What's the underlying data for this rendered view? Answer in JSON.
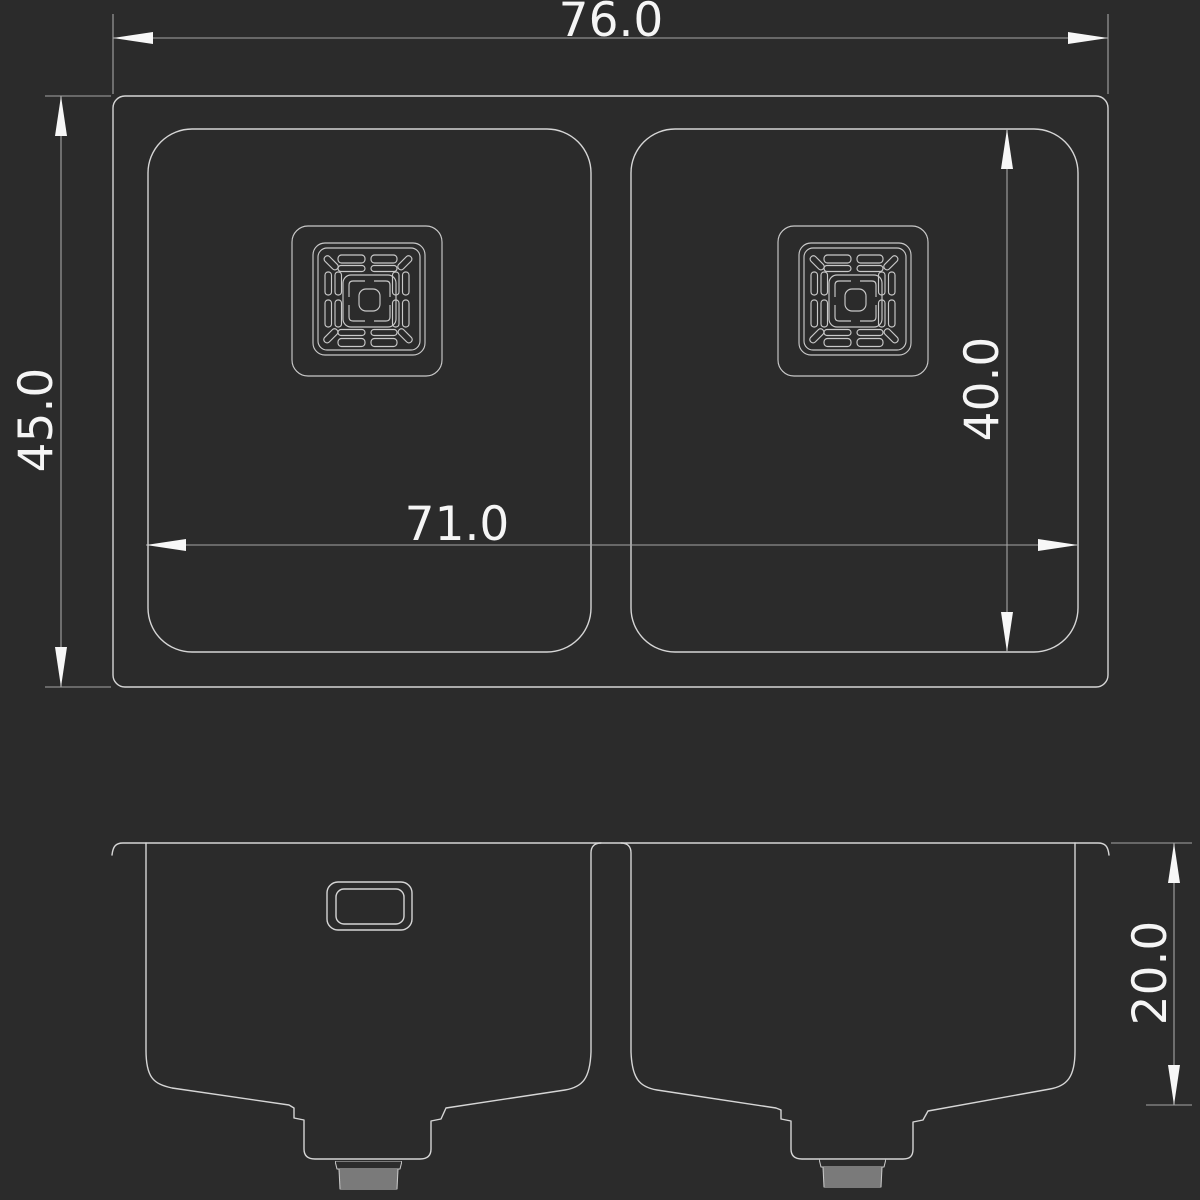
{
  "drawing": {
    "background_color": "#2b2b2b",
    "geometry_line_color": "#d6d6d6",
    "detail_line_color": "#c9c9c9",
    "dimension_line_color": "#a6a6a6",
    "dimension_text_color": "#f5f5f5",
    "arrow_color": "#f7f7f7",
    "dimensions": {
      "overall_width": "76.0",
      "overall_depth": "45.0",
      "combined_bowl_width": "71.0",
      "bowl_inner_depth": "40.0",
      "bowl_height": "20.0"
    }
  }
}
